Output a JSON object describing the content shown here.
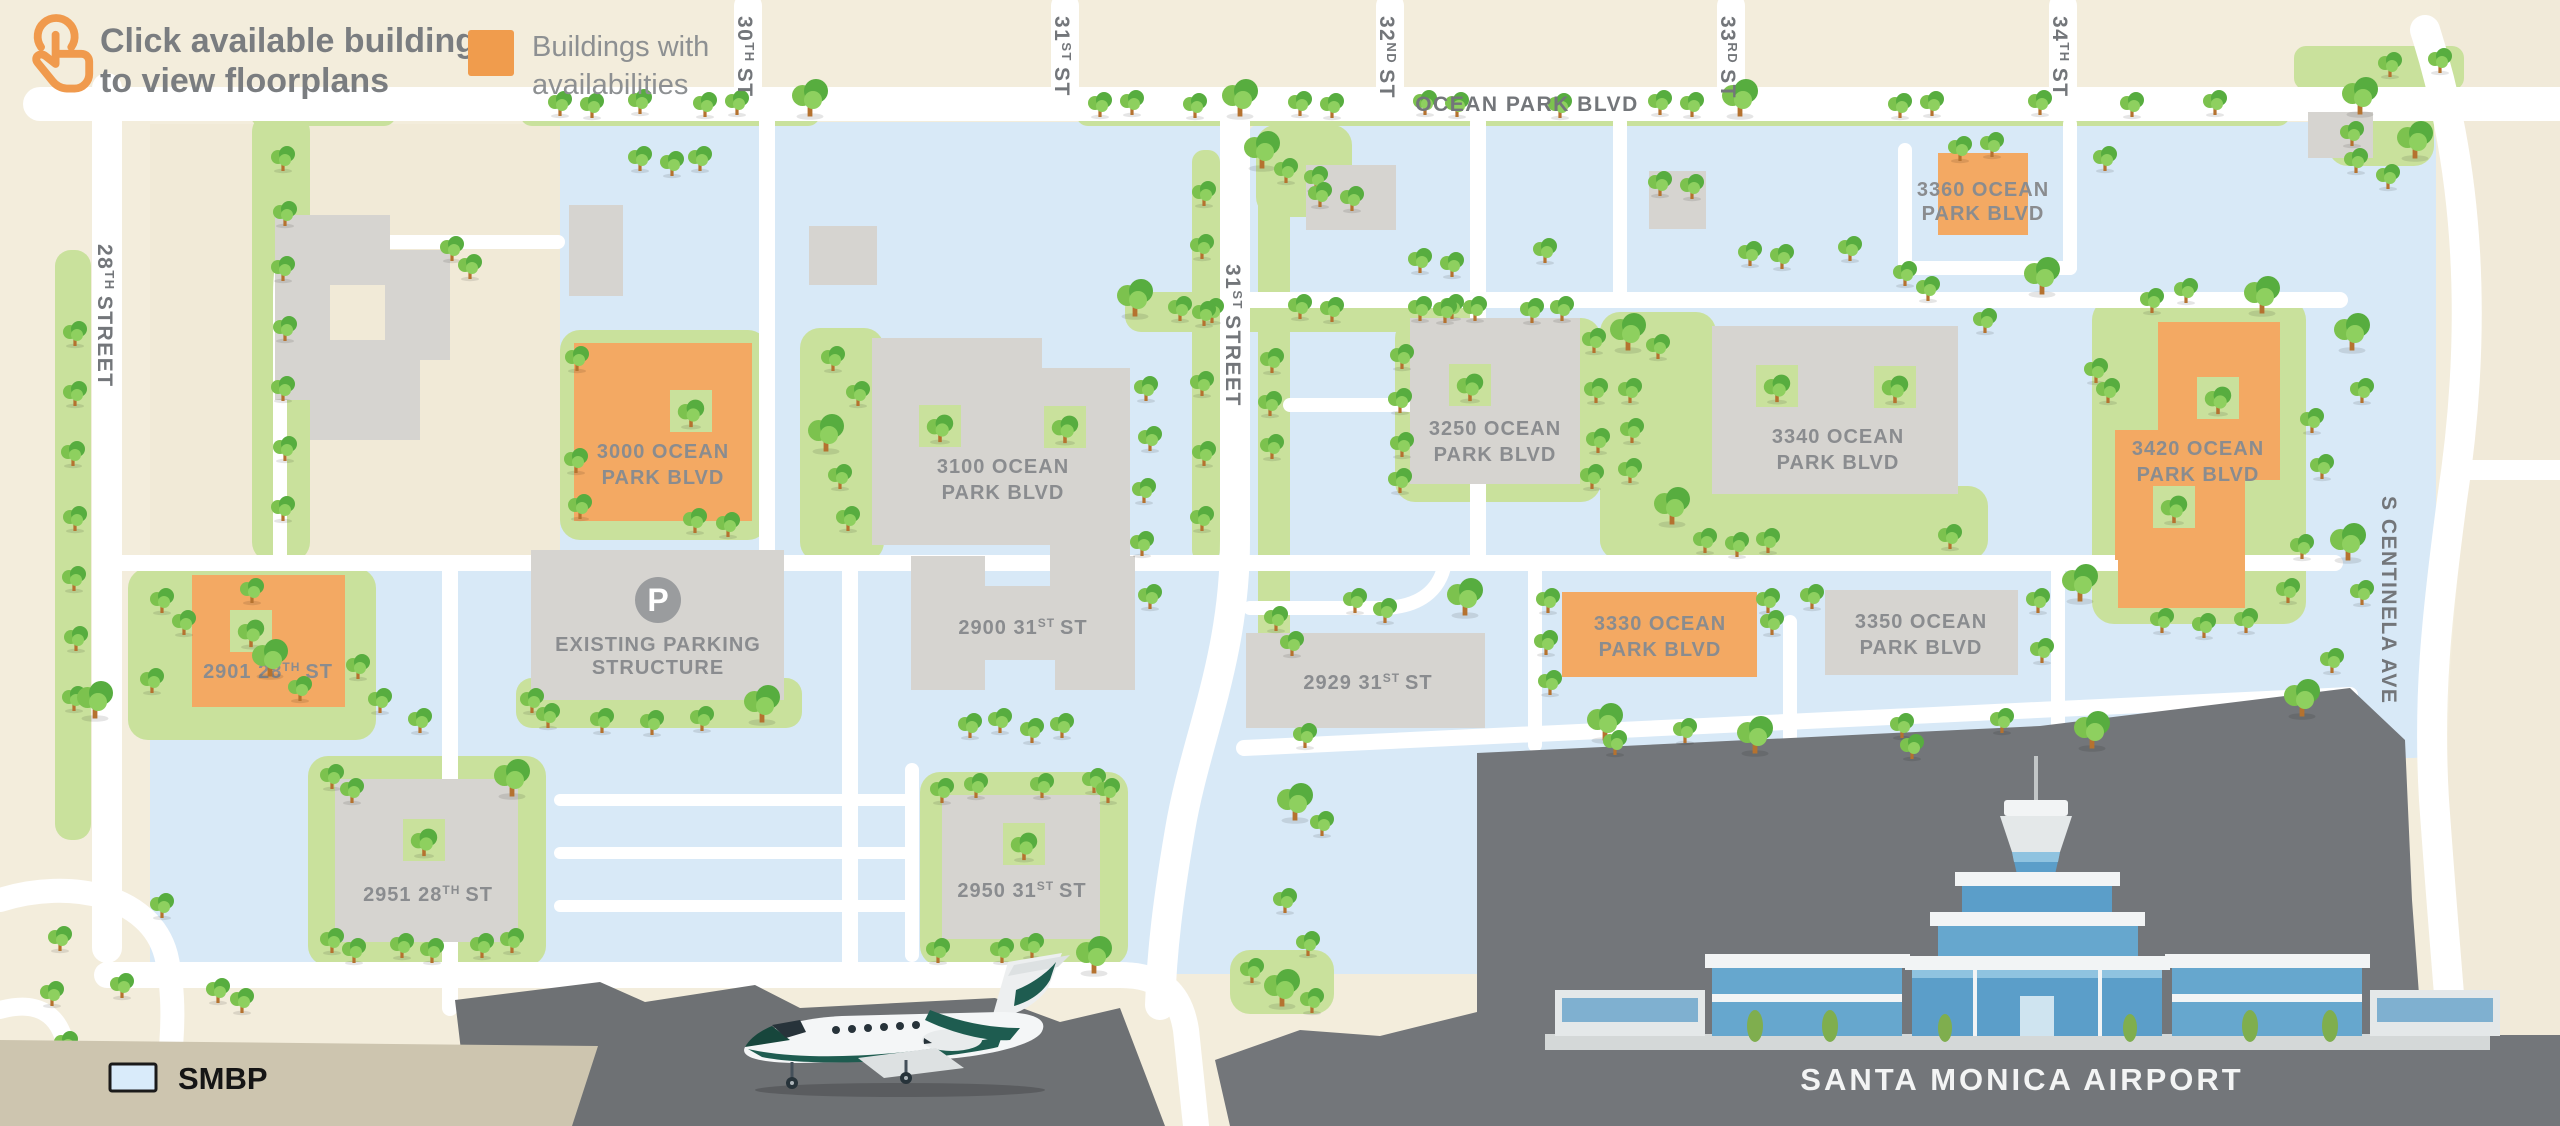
{
  "header": {
    "title_line1": "Click available buildings",
    "title_line2": "to view floorplans",
    "legend_line1": "Buildings with",
    "legend_line2": "availabilities"
  },
  "streets": {
    "s28": {
      "pre": "28",
      "sup": "TH",
      "post": "STREET"
    },
    "s30": {
      "pre": "30",
      "sup": "TH",
      "post": "ST"
    },
    "s31top": {
      "pre": "31",
      "sup": "ST",
      "post": "ST"
    },
    "s32": {
      "pre": "32",
      "sup": "ND",
      "post": "ST"
    },
    "s33": {
      "pre": "33",
      "sup": "RD",
      "post": "ST"
    },
    "s34": {
      "pre": "34",
      "sup": "TH",
      "post": "ST"
    },
    "s31mid": {
      "pre": "31",
      "sup": "ST",
      "post": "STREET"
    },
    "ocean_park": {
      "label": "OCEAN PARK BLVD"
    },
    "centinela": {
      "label": "S CENTINELA AVE"
    }
  },
  "buildings": {
    "b3000": {
      "line1": "3000 OCEAN",
      "line2": "PARK BLVD",
      "available": true
    },
    "b3100": {
      "line1": "3100 OCEAN",
      "line2": "PARK BLVD",
      "available": false
    },
    "b3250": {
      "line1": "3250 OCEAN",
      "line2": "PARK BLVD",
      "available": false
    },
    "b3340": {
      "line1": "3340 OCEAN",
      "line2": "PARK BLVD",
      "available": false
    },
    "b3360": {
      "line1": "3360 OCEAN",
      "line2": "PARK BLVD",
      "available": true
    },
    "b3420": {
      "line1": "3420 OCEAN",
      "line2": "PARK BLVD",
      "available": true
    },
    "b3330": {
      "line1": "3330 OCEAN",
      "line2": "PARK BLVD",
      "available": true
    },
    "b3350": {
      "line1": "3350 OCEAN",
      "line2": "PARK BLVD",
      "available": false
    },
    "b2900": {
      "pre": "2900 31",
      "sup": "ST",
      "post": "ST",
      "available": false
    },
    "b2929": {
      "pre": "2929 31",
      "sup": "ST",
      "post": "ST",
      "available": false
    },
    "b2901": {
      "pre": "2901 28",
      "sup": "TH",
      "post": "ST",
      "available": true
    },
    "b2951": {
      "pre": "2951 28",
      "sup": "TH",
      "post": "ST",
      "available": false
    },
    "b2950": {
      "pre": "2950 31",
      "sup": "ST",
      "post": "ST",
      "available": false
    },
    "parking": {
      "line1": "EXISTING PARKING",
      "line2": "STRUCTURE",
      "icon_letter": "P"
    }
  },
  "airport": {
    "label": "SANTA MONICA AIRPORT"
  },
  "legend": {
    "smbp_label": "SMBP"
  },
  "colors": {
    "available": "#F3A963",
    "legend_swatch": "#F09C4D",
    "standard": "#D6D4D0",
    "campus_blue": "#D8E9F7",
    "green": "#C9E19C",
    "road": "#FFFFFF",
    "beige": "#F3EDDC",
    "airport_gray": "#73767A",
    "smbp_swatch": "#D9EBFA",
    "smbp_panel": "#CDC5AF"
  }
}
